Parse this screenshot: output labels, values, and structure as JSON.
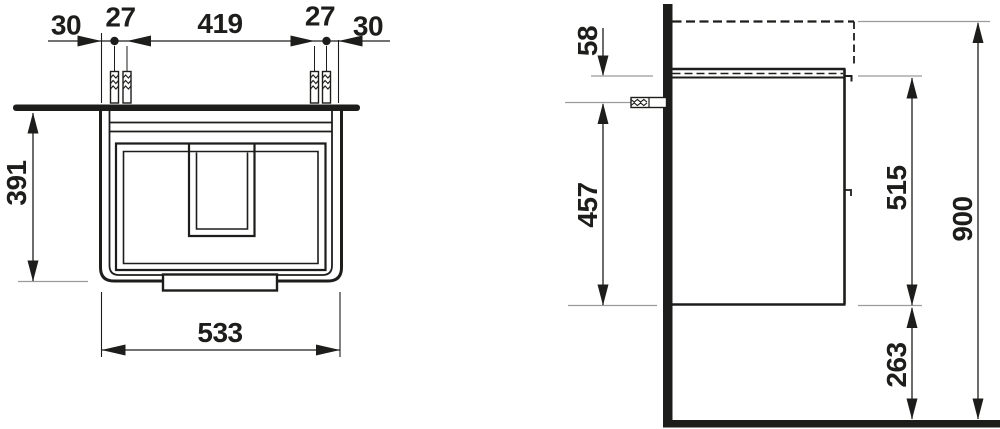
{
  "drawing": {
    "kind": "vanity-unit-installation-drawing",
    "units": "mm"
  },
  "views": {
    "bottom_view": {
      "dims": {
        "edge_to_plug_left": "30",
        "plug_pair_left": "27",
        "plug_span": "419",
        "plug_pair_right": "27",
        "edge_to_plug_right": "30",
        "depth": "391",
        "width": "533"
      }
    },
    "side_view": {
      "dims": {
        "basin_top_to_carcass_top": "58",
        "plug_to_cabinet_bottom": "457",
        "cabinet_height": "515",
        "total_height": "900",
        "floor_clearance": "263"
      }
    },
    "colors": {
      "line": "#1d1d1b",
      "extension_line": "#9b9b9b",
      "background": "#ffffff"
    }
  }
}
